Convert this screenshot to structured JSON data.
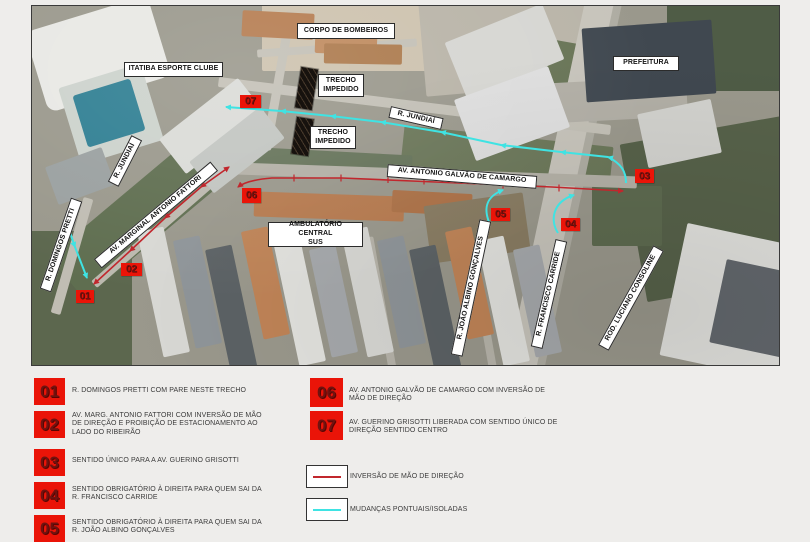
{
  "map": {
    "labels": [
      {
        "id": "corpo-de-bombeiros",
        "text": "CORPO DE BOMBEIROS"
      },
      {
        "id": "itatiba-esporte-clube",
        "text": "ITATIBA ESPORTE CLUBE"
      },
      {
        "id": "trecho-impedido-1",
        "text": "TRECHO\nIMPEDIDO"
      },
      {
        "id": "trecho-impedido-2",
        "text": "TRECHO\nIMPEDIDO"
      },
      {
        "id": "r-jundiai-oeste",
        "text": "R. JUNDIAÍ"
      },
      {
        "id": "r-jundiai-leste",
        "text": "R. JUNDIAÍ"
      },
      {
        "id": "prefeitura",
        "text": "PREFEITURA"
      },
      {
        "id": "av-antonio-galvao-de-camargo",
        "text": "AV. ANTONIO GALVÃO DE CAMARGO"
      },
      {
        "id": "ambulatorio-central-sus",
        "text": "AMBULATÓRIO CENTRAL\nSUS"
      },
      {
        "id": "r-domingos-pretti",
        "text": "R. DOMINGOS PRETTI"
      },
      {
        "id": "av-marginal-antonio-fattori",
        "text": "AV. MARGINAL ANTONIO FATTORI"
      },
      {
        "id": "r-joao-albino-goncalves",
        "text": "R. JOÃO ALBINO GONÇALVES"
      },
      {
        "id": "r-francisco-carride",
        "text": "R. FRANCISCO CARRIDE"
      },
      {
        "id": "rod-luciano-consoline",
        "text": "ROD. LUCIANO CONSOLINE"
      }
    ],
    "markers": [
      {
        "num": "01"
      },
      {
        "num": "02"
      },
      {
        "num": "03"
      },
      {
        "num": "04"
      },
      {
        "num": "05"
      },
      {
        "num": "06"
      },
      {
        "num": "07"
      }
    ]
  },
  "legend": {
    "items": [
      {
        "num": "01",
        "text": "R. DOMINGOS PRETTI COM PARE NESTE TRECHO"
      },
      {
        "num": "02",
        "text": "AV. MARG. ANTONIO FATTORI COM INVERSÃO DE MÃO\nDE DIREÇÃO E PROIBIÇÃO DE ESTACIONAMENTO AO\nLADO DO RIBEIRÃO"
      },
      {
        "num": "03",
        "text": "SENTIDO ÚNICO PARA A AV. GUERINO GRISOTTI"
      },
      {
        "num": "04",
        "text": "SENTIDO OBRIGATÓRIO À DIREITA PARA QUEM SAI DA\nR. FRANCISCO CARRIDE"
      },
      {
        "num": "05",
        "text": "SENTIDO OBRIGATÓRIO À DIREITA PARA QUEM SAI DA\nR. JOÃO ALBINO GONÇALVES"
      },
      {
        "num": "06",
        "text": "AV. ANTONIO GALVÃO DE CAMARGO COM INVERSÃO DE\nMÃO DE DIREÇÃO"
      },
      {
        "num": "07",
        "text": "AV. GUERINO GRISOTTI LIBERADA COM SENTIDO ÚNICO DE\nDIREÇÃO SENTIDO CENTRO"
      }
    ],
    "key": [
      {
        "swatch": "red-line",
        "label": "INVERSÃO DE MÃO DE DIREÇÃO"
      },
      {
        "swatch": "cyan-line",
        "label": "MUDANÇAS PONTUAIS/ISOLADAS"
      }
    ]
  },
  "colors": {
    "page_bg": "#eeedeb",
    "red_route": "#c1272d",
    "cyan_route": "#3fe3e3",
    "marker_bg": "#ea1408",
    "marker_text": "#701310",
    "label_bg": "#ffffff",
    "label_border": "#2b2b2b"
  }
}
